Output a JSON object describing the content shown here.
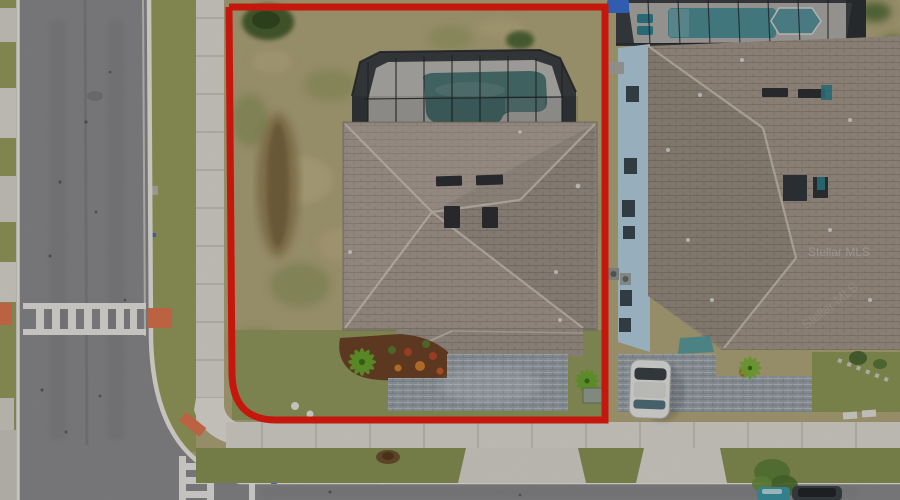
{
  "image": {
    "type": "aerial-photo",
    "description": "Overhead drone photo of a corner-lot single-family home with a screened pool, lot outlined in red",
    "watermark": "Stellar MLS"
  },
  "colors": {
    "grass_dry": "#b2a77c",
    "grass_green": "#8a9455",
    "grass_front": "#959c5f",
    "grass_verge": "#9aa060",
    "asphalt": "#8d8d90",
    "concrete": "#dedbd3",
    "concrete_light": "#e6e4dc",
    "curb": "#eceae2",
    "roof_main": "#a89c91",
    "roof_lower": "#a1968b",
    "roof_neighbor": "#a3978b",
    "pool_subject": "#4c7573",
    "pool_neighbor": "#4f8e96",
    "pool_deck": "#c4c2bd",
    "screen_dark": "#3c4044",
    "boundary_red": "#ee1c0f",
    "pavers": "#9ba4ac",
    "mulch": "#6f4328",
    "palm_green": "#6aa82e",
    "car_white": "#e9e9e7",
    "car_glass": "#3c4247",
    "tactile_pad_orange": "#e0764f",
    "tarp_blue": "#3b70d4",
    "wall_blue": "#b5d2e2",
    "road_paint": "#f2f1ec",
    "vent_dark": "#2e3134"
  }
}
